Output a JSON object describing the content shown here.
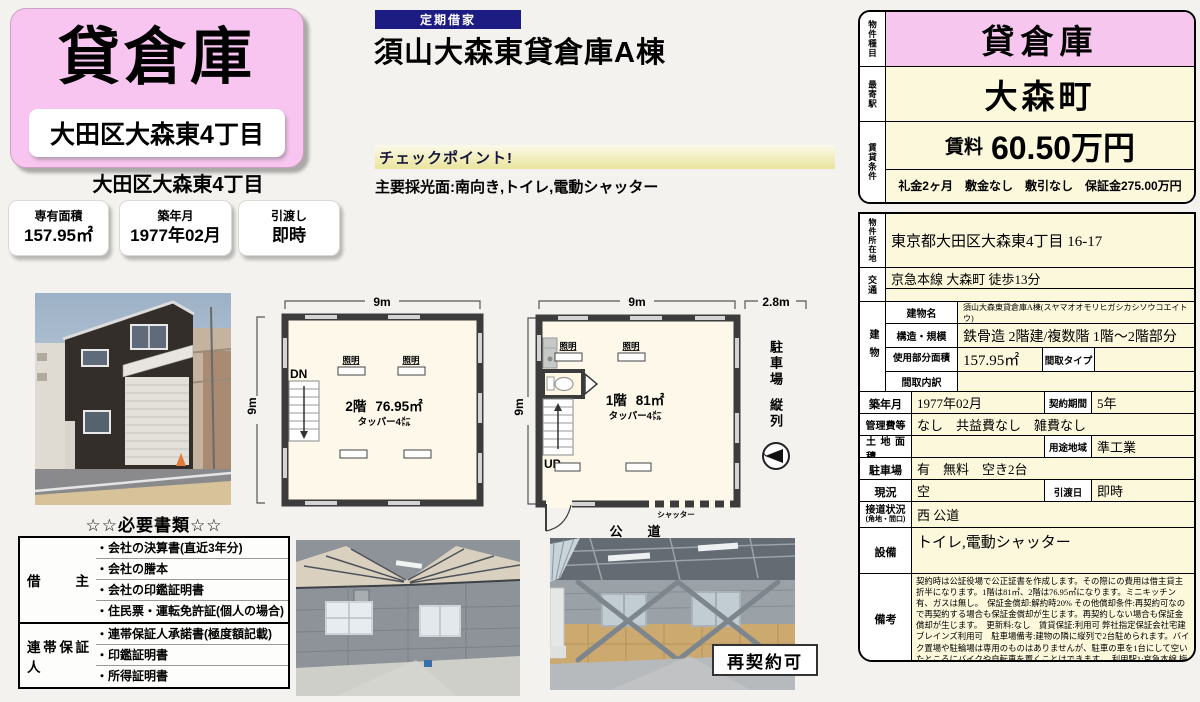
{
  "left": {
    "type_label": "貸倉庫",
    "banner": "大田区大森東4丁目",
    "sub_location": "大田区大森東4丁目",
    "boxes": [
      {
        "label": "専有面積",
        "value": "157.95㎡"
      },
      {
        "label": "築年月",
        "value": "1977年02月"
      },
      {
        "label": "引渡し",
        "value": "即時"
      }
    ]
  },
  "main": {
    "badge": "定期借家",
    "title": "須山大森東貸倉庫A棟",
    "checkpoint_label": "チェックポイント!",
    "lighting_note": "主要採光面:南向き,トイレ,電動シャッター"
  },
  "summary": {
    "type_header": "物件種目",
    "type_value": "貸倉庫",
    "station_header": "最寄駅",
    "station_value": "大森町",
    "terms_header": "賃貸条件",
    "rent_label": "賃料",
    "rent_value": "60.50万円",
    "terms_detail": "礼金2ヶ月　敷金なし　敷引なし　保証金275.00万円"
  },
  "details": {
    "location_header": "物件所在地",
    "location": "東京都大田区大森東4丁目 16-17",
    "access_header": "交通",
    "access": "京急本線 大森町 徒歩13分",
    "access2": "",
    "building_header": "建物",
    "building_name_label": "建物名",
    "building_name": "須山大森東貸倉庫A棟(スヤマオオモリヒガシカシソウコエイトウ)",
    "structure_label": "構造・規模",
    "structure": "鉄骨造 2階建/複数階 1階〜2階部分",
    "area_label": "使用部分面積",
    "area": "157.95㎡",
    "layout_type_label": "間取タイプ",
    "layout_type": "",
    "layout_detail_label": "間取内訳",
    "layout_detail": "",
    "built_label": "築年月",
    "built": "1977年02月",
    "term_label": "契約期間",
    "term": "5年",
    "fees_label": "管理費等",
    "fees": "なし　共益費なし　雑費なし",
    "land_label": "土地面積",
    "land": "",
    "zone_label": "用途地域",
    "zone": "準工業",
    "parking_label": "駐車場",
    "parking": "有　無料　空き2台",
    "status_label": "現況",
    "status": "空",
    "handover_label": "引渡日",
    "handover": "即時",
    "road_label": "接道状況",
    "road_label_sub": "(角地・間口)",
    "road": "西 公道",
    "equip_label": "設備",
    "equip": "トイレ,電動シャッター",
    "notes_label": "備考",
    "notes": "契約時は公証役場で公正証書を作成します。その際にの費用は借主貸主折半になります。1階は81㎡、2階は76.95㎡になります。ミニキッチン有、ガスは無し。　保証金償却:解約時20% その他償却条件:再契約可なので再契約する場合も保証金償却が生じます。再契約しない場合も保証金償却が生じます。　更新料:なし　賃貸保証:利用可 弊社指定保証会社宅建ブレインズ利用可　駐車場備考:建物の隣に縦列で2台駐められます。バイク置場や駐輪場は専用のものはありませんが、駐車の車を1台にして空いたところにバイクや自転車を置くことはできます。　利用駅1:京急本線 梅屋敷 徒歩14分　利用駅2:東京モノレール羽田線 昭和島 徒歩16分"
  },
  "documents": {
    "title": "☆☆必要書類☆☆",
    "tenant_label": "借主",
    "tenant_items": [
      "・会社の決算書(直近3年分)",
      "・会社の謄本",
      "・会社の印鑑証明書",
      "・住民票・運転免許証(個人の場合)"
    ],
    "guarantor_label": "連帯保証人",
    "guarantor_items": [
      "・連帯保証人承諾書(極度額記載)",
      "・印鑑証明書",
      "・所得証明書"
    ]
  },
  "plan2f": {
    "dim_w": "9m",
    "dim_h": "9m",
    "stairs": "DN",
    "light": "照明",
    "floor": "2階",
    "area": "76.95㎡",
    "height_note": "タッパー4㍍"
  },
  "plan1f": {
    "dim_w": "9m",
    "dim_side": "2.8m",
    "dim_h": "9m",
    "stairs": "UP",
    "light": "照明",
    "floor": "1階",
    "area": "81㎡",
    "height_note": "タッパー4㍍",
    "shutter": "シャッター",
    "road": "公　道",
    "parking1": "駐車場",
    "parking2": "縦列"
  },
  "footer": {
    "renewal": "再契約可"
  }
}
